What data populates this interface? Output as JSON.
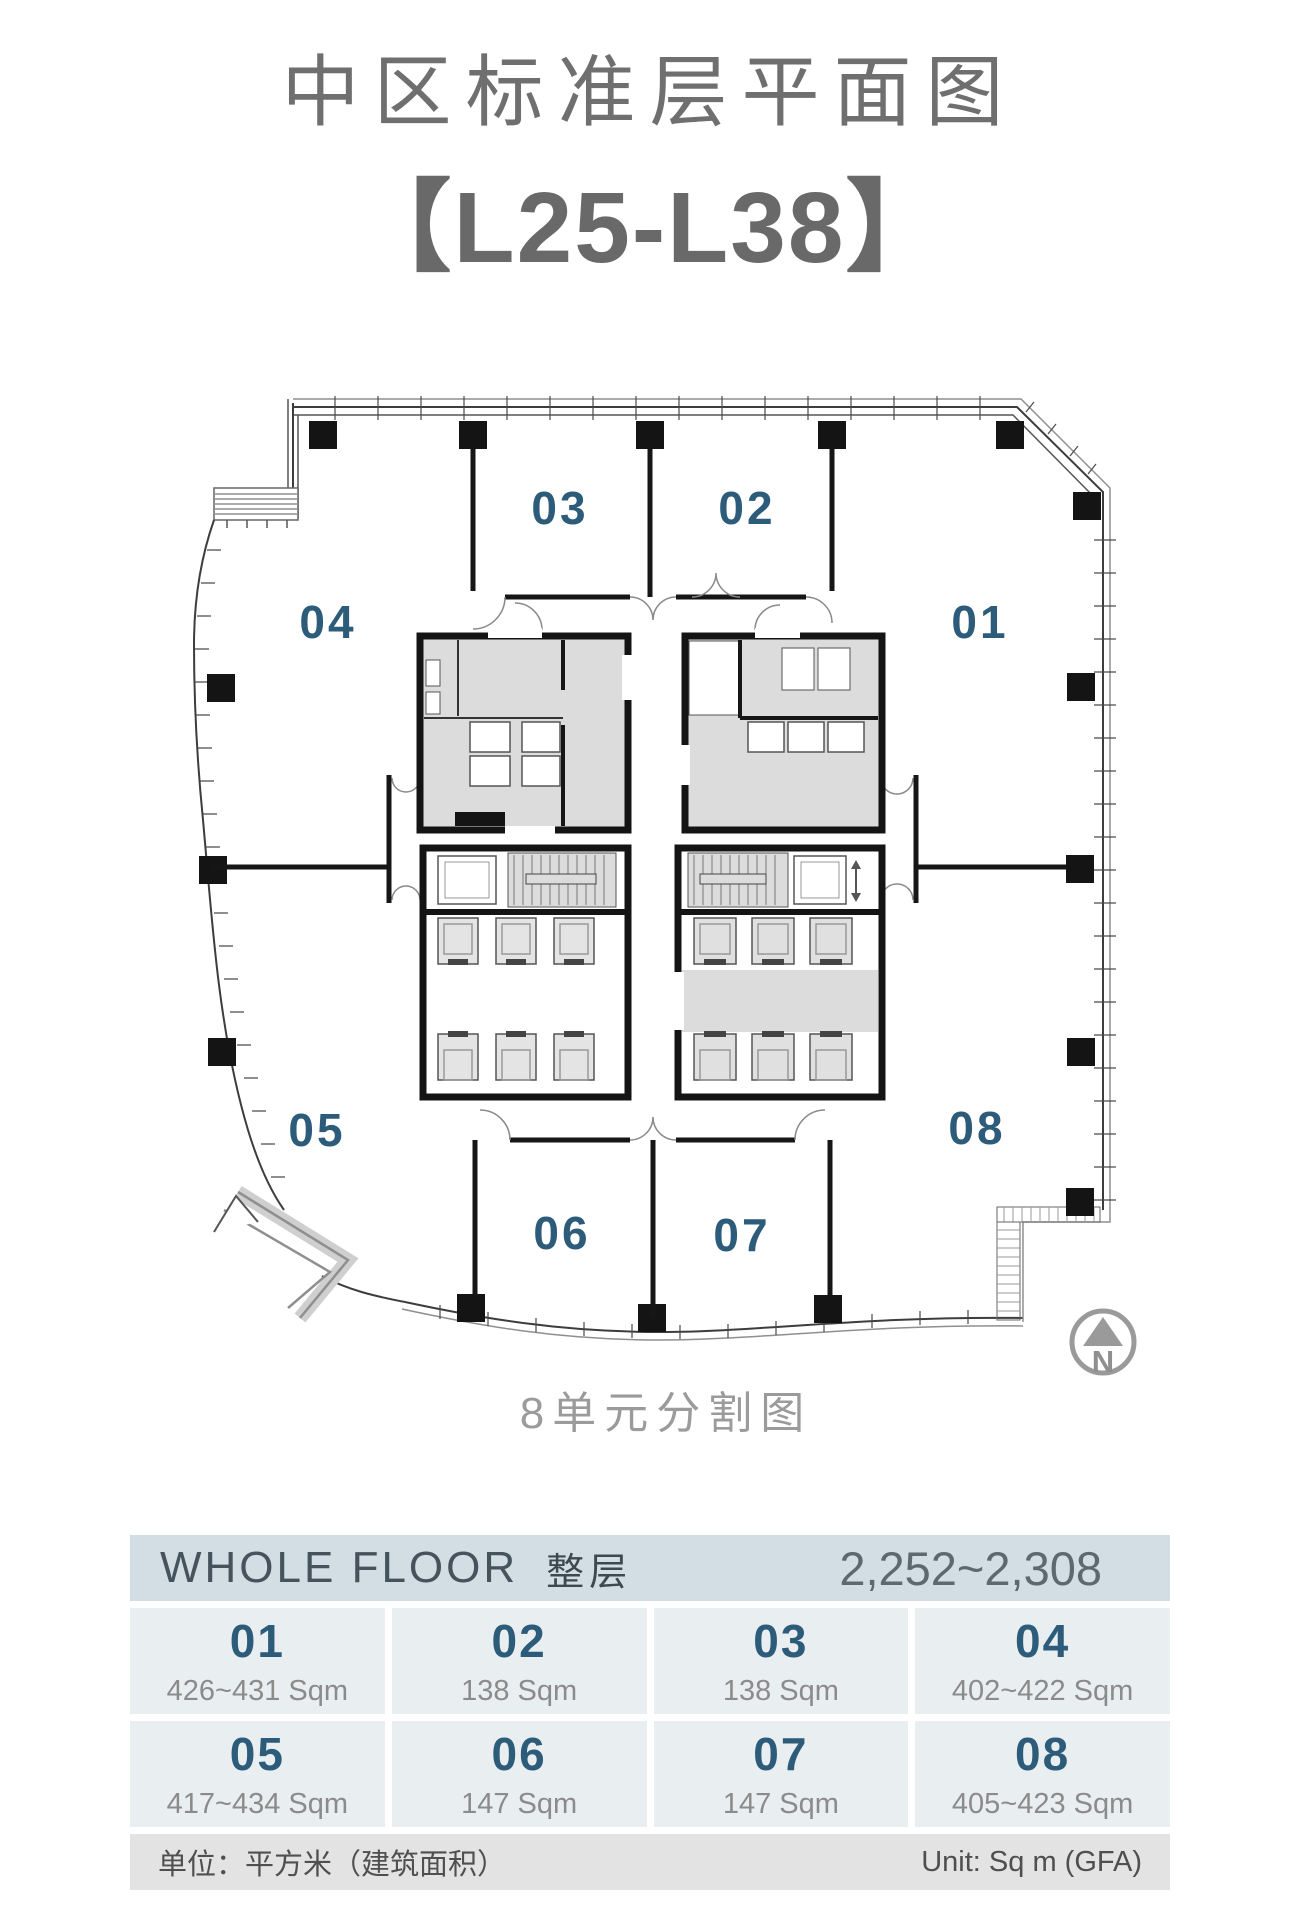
{
  "title": "中区标准层平面图",
  "subtitle": "【L25-L38】",
  "plan": {
    "caption": "8单元分割图",
    "north_label": "N",
    "units": [
      "01",
      "02",
      "03",
      "04",
      "05",
      "06",
      "07",
      "08"
    ]
  },
  "table": {
    "header": {
      "whole_floor_en": "WHOLE FLOOR",
      "whole_floor_zh": "整层",
      "range": "2,252~2,308"
    },
    "cells": [
      {
        "unit": "01",
        "area": "426~431 Sqm"
      },
      {
        "unit": "02",
        "area": "138 Sqm"
      },
      {
        "unit": "03",
        "area": "138 Sqm"
      },
      {
        "unit": "04",
        "area": "402~422 Sqm"
      },
      {
        "unit": "05",
        "area": "417~434 Sqm"
      },
      {
        "unit": "06",
        "area": "147 Sqm"
      },
      {
        "unit": "07",
        "area": "147 Sqm"
      },
      {
        "unit": "08",
        "area": "405~423 Sqm"
      }
    ],
    "footer": {
      "unit_note_zh": "单位：平方米（建筑面积）",
      "unit_note_en": "Unit: Sq m (GFA)"
    }
  },
  "colors": {
    "accent_blue": "#2d5b7a",
    "title_gray": "#6f6f6f",
    "header_bg": "#d2dee3",
    "cell_bg": "#e9eef1",
    "footer_bg": "#e3e3e3",
    "wall_black": "#141414",
    "core_gray": "#dcdcdc"
  }
}
